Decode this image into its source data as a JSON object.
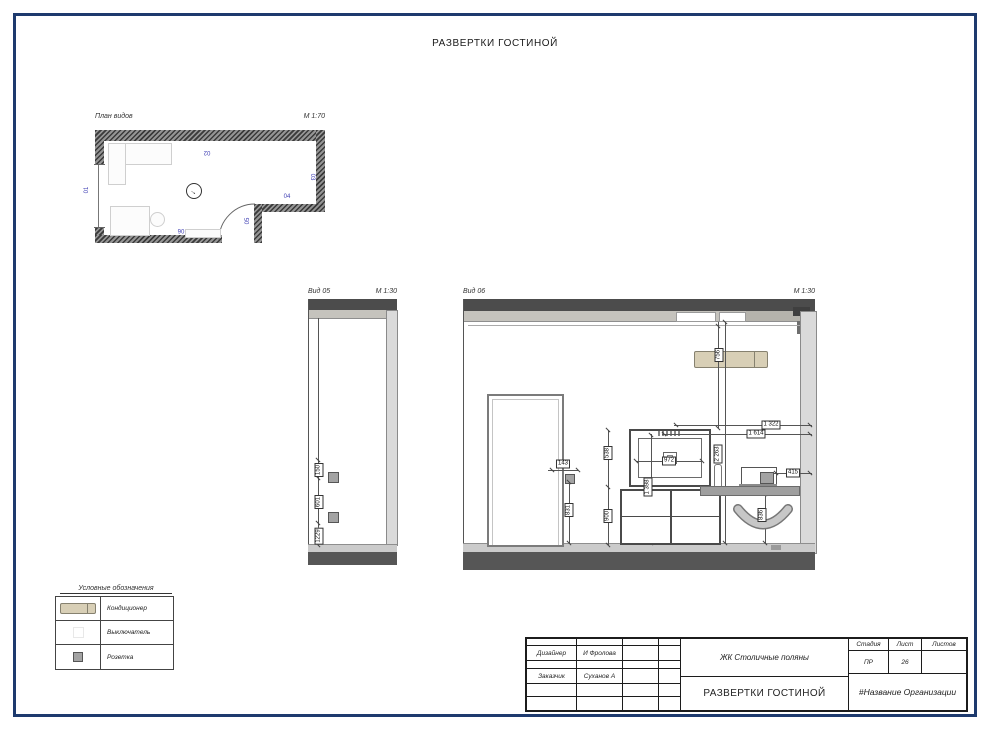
{
  "page": {
    "title": "РАЗВЕРТКИ ГОСТИНОЙ"
  },
  "plan": {
    "label": "План видов",
    "scale": "М 1:70",
    "markers": {
      "m01": "01",
      "m02": "02",
      "m03": "03",
      "m04": "04",
      "m05": "05",
      "m06": "06"
    }
  },
  "view05": {
    "label": "Вид 05",
    "scale": "М 1:30",
    "dims": {
      "switch_height": "150",
      "middle_gap": "601",
      "socket_height": "1229"
    }
  },
  "view06": {
    "label": "Вид 06",
    "scale": "М 1:30",
    "dims": {
      "ac_width": "756",
      "tv_width": "972",
      "tv_height": "538",
      "cabinet_height": "900",
      "tv_center_height": "1 398",
      "tv_to_wall": "1 322",
      "tv_edge_to_wall": "1 614",
      "wall_height": "2 263",
      "socket_to_wall": "415",
      "desk_height": "836",
      "door_to_socket": "143",
      "socket_height": "831"
    }
  },
  "legend": {
    "title": "Условные обозначения",
    "items": [
      {
        "symbol": "air-conditioner",
        "label": "Кондиционер"
      },
      {
        "symbol": "switch",
        "label": "Выключатель"
      },
      {
        "symbol": "socket",
        "label": "Розетка"
      }
    ]
  },
  "titleblock": {
    "designer_label": "Дизайнер",
    "designer_value": "И Фролова",
    "client_label": "Заказчик",
    "client_value": "Суханов А",
    "project": "ЖК Столичные поляны",
    "sheet_title": "РАЗВЕРТКИ ГОСТИНОЙ",
    "stage_label": "Стадия",
    "stage_value": "ПР",
    "sheet_label": "Лист",
    "sheet_value": "26",
    "sheets_label": "Листов",
    "sheets_value": "",
    "organization": "#Название Организации"
  },
  "colors": {
    "frame": "#1e3a6e",
    "wall_section": "#4c4c4c",
    "air_conditioner": "#d8cfb6",
    "view_marker": "#3d3db3"
  }
}
